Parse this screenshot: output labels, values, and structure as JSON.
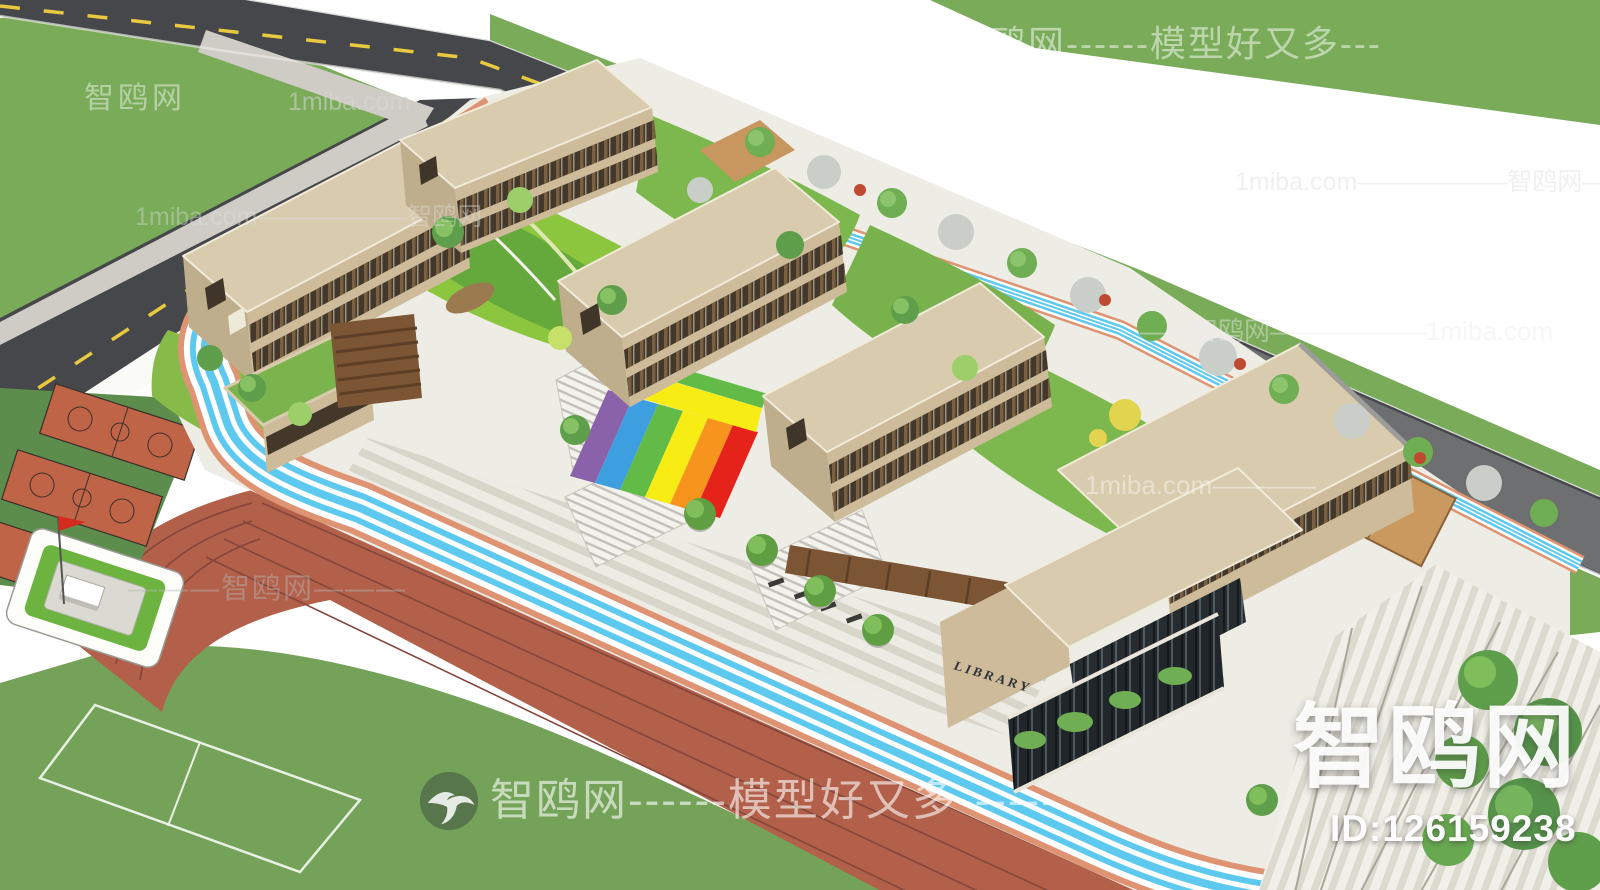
{
  "scene": {
    "description": "Aerial axonometric 3D model render of a school campus with classroom buildings, roof gardens, rainbow walkway, running track, basketball courts and library"
  },
  "watermarks": {
    "top_right": "智鸥网------模型好又多---",
    "top_left_brand": "智鸥网",
    "top_left_site": "1miba.com",
    "left_road": "1miba.com——————智鸥网",
    "right_top_faint": "1miba.com——————智鸥网—",
    "right_road": "——智鸥网——————1miba.com",
    "left_plaza": "———智鸥网———",
    "center_right": "1miba.com————",
    "bottom_center": "智鸥网------模型好又多------",
    "brand_large": "智鸥网",
    "model_id": "ID:126159238"
  },
  "labels": {
    "library_sign": "LIBRARY"
  },
  "palette": {
    "grass": "#79ab58",
    "asphalt_road": "#45474a",
    "gray_road": "#6d6f71",
    "lane_marking_yellow": "#e8c93f",
    "building_tan": "#d9cbae",
    "facade_tan": "#cdbb9a",
    "window_band_dark": "#44382a",
    "roof_garden_green": "#8cc63f",
    "lawn_green": "#7db84e",
    "track_red": "#b2604a",
    "field_green": "#74a259",
    "court_orange": "#c06448",
    "jog_cyan": "#5ec9ef",
    "jog_salmon": "#de9372",
    "flag_red": "#d42b1e",
    "glass_dark": "#262c30",
    "rainbow": [
      "#8a62aa",
      "#3e9fe0",
      "#62bb46",
      "#f7ec13",
      "#f7941d",
      "#e5231b"
    ]
  }
}
